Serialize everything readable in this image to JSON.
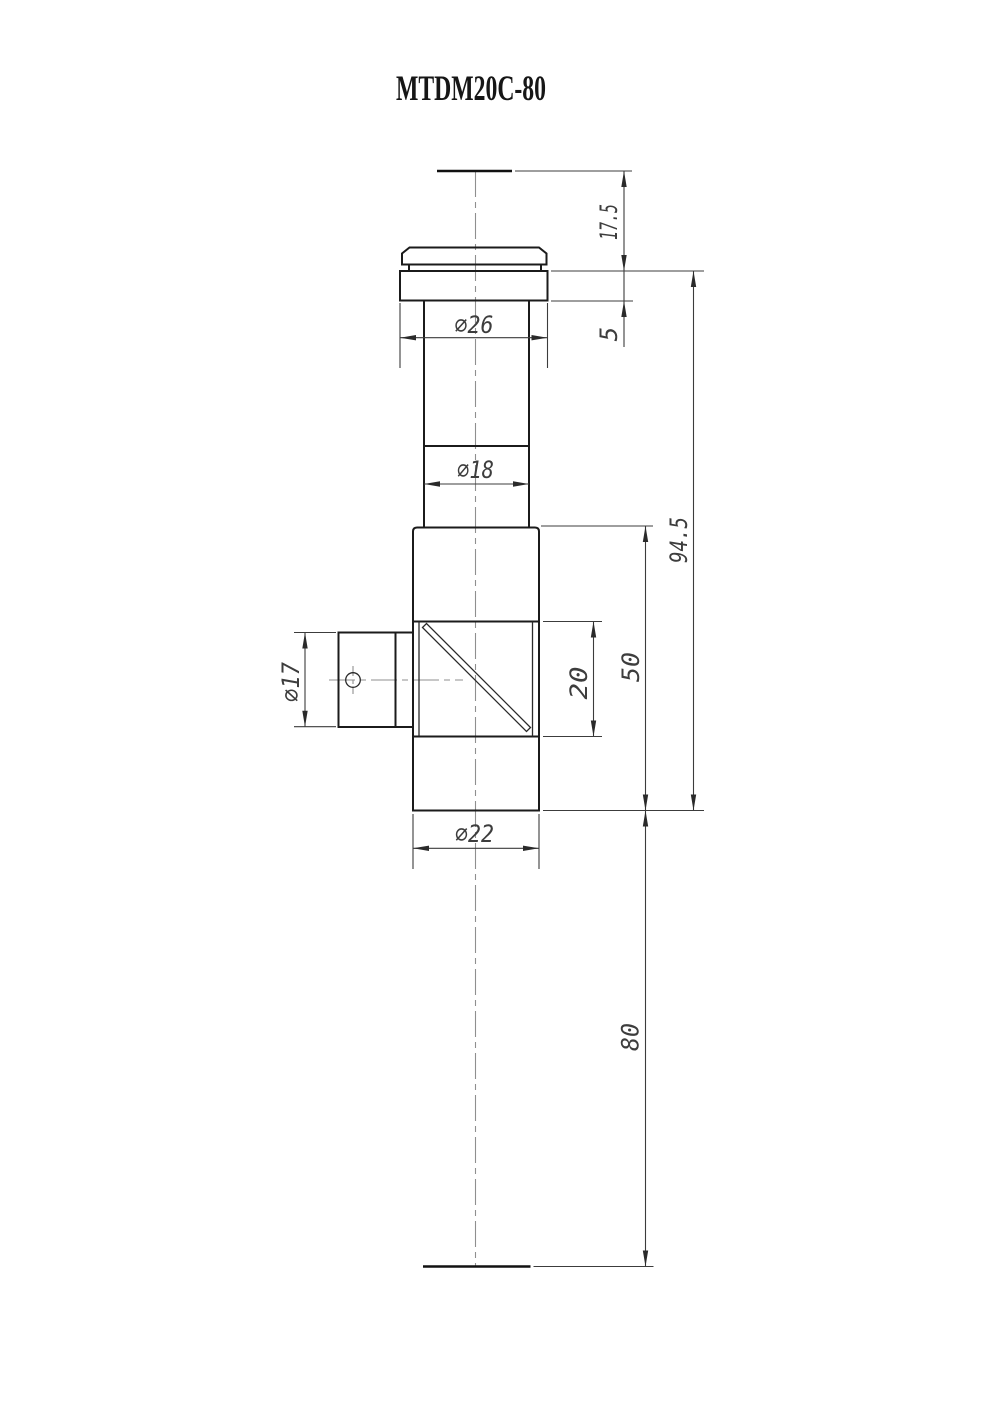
{
  "drawing": {
    "title": "MTDM20C-80",
    "dimensions": {
      "top_to_flange": "17.5",
      "flange_thickness": "5",
      "flange_diameter": "∅26",
      "tube_diameter": "∅18",
      "overall_height": "94.5",
      "body_height": "50",
      "window_height": "20",
      "port_diameter": "∅17",
      "body_diameter": "∅22",
      "bottom_distance": "80"
    }
  }
}
